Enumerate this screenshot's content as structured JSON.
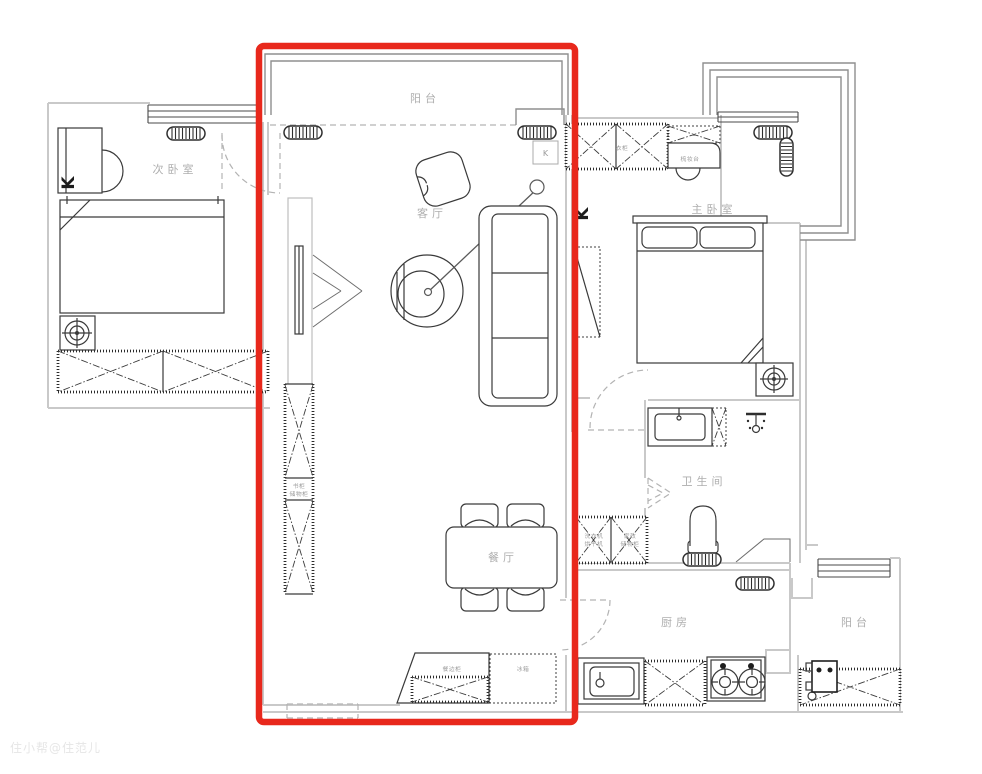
{
  "watermark": "住小帮@住范儿",
  "colors": {
    "highlight_red": "#e8281c"
  },
  "rooms": {
    "balcony_top": "阳台",
    "secondary_bedroom": "次卧室",
    "living_room": "客厅",
    "master_bedroom": "主卧室",
    "bathroom": "卫生间",
    "dining_room": "餐厅",
    "kitchen": "厨房",
    "balcony_kitchen": "阳台"
  },
  "furniture": {
    "wardrobe_master": "衣柜",
    "dressing_table": "梳妆台",
    "cabinet_line1": "书柜",
    "cabinet_line2": "储物柜",
    "washer_line1": "洗衣机",
    "washer_line2": "烘干机",
    "storage_line1": "家政",
    "storage_line2": "储物柜",
    "sideboard": "餐边柜",
    "fridge": "冰箱"
  },
  "markers": {
    "radiator_letter": "K",
    "radiator_box_letter": "K"
  }
}
